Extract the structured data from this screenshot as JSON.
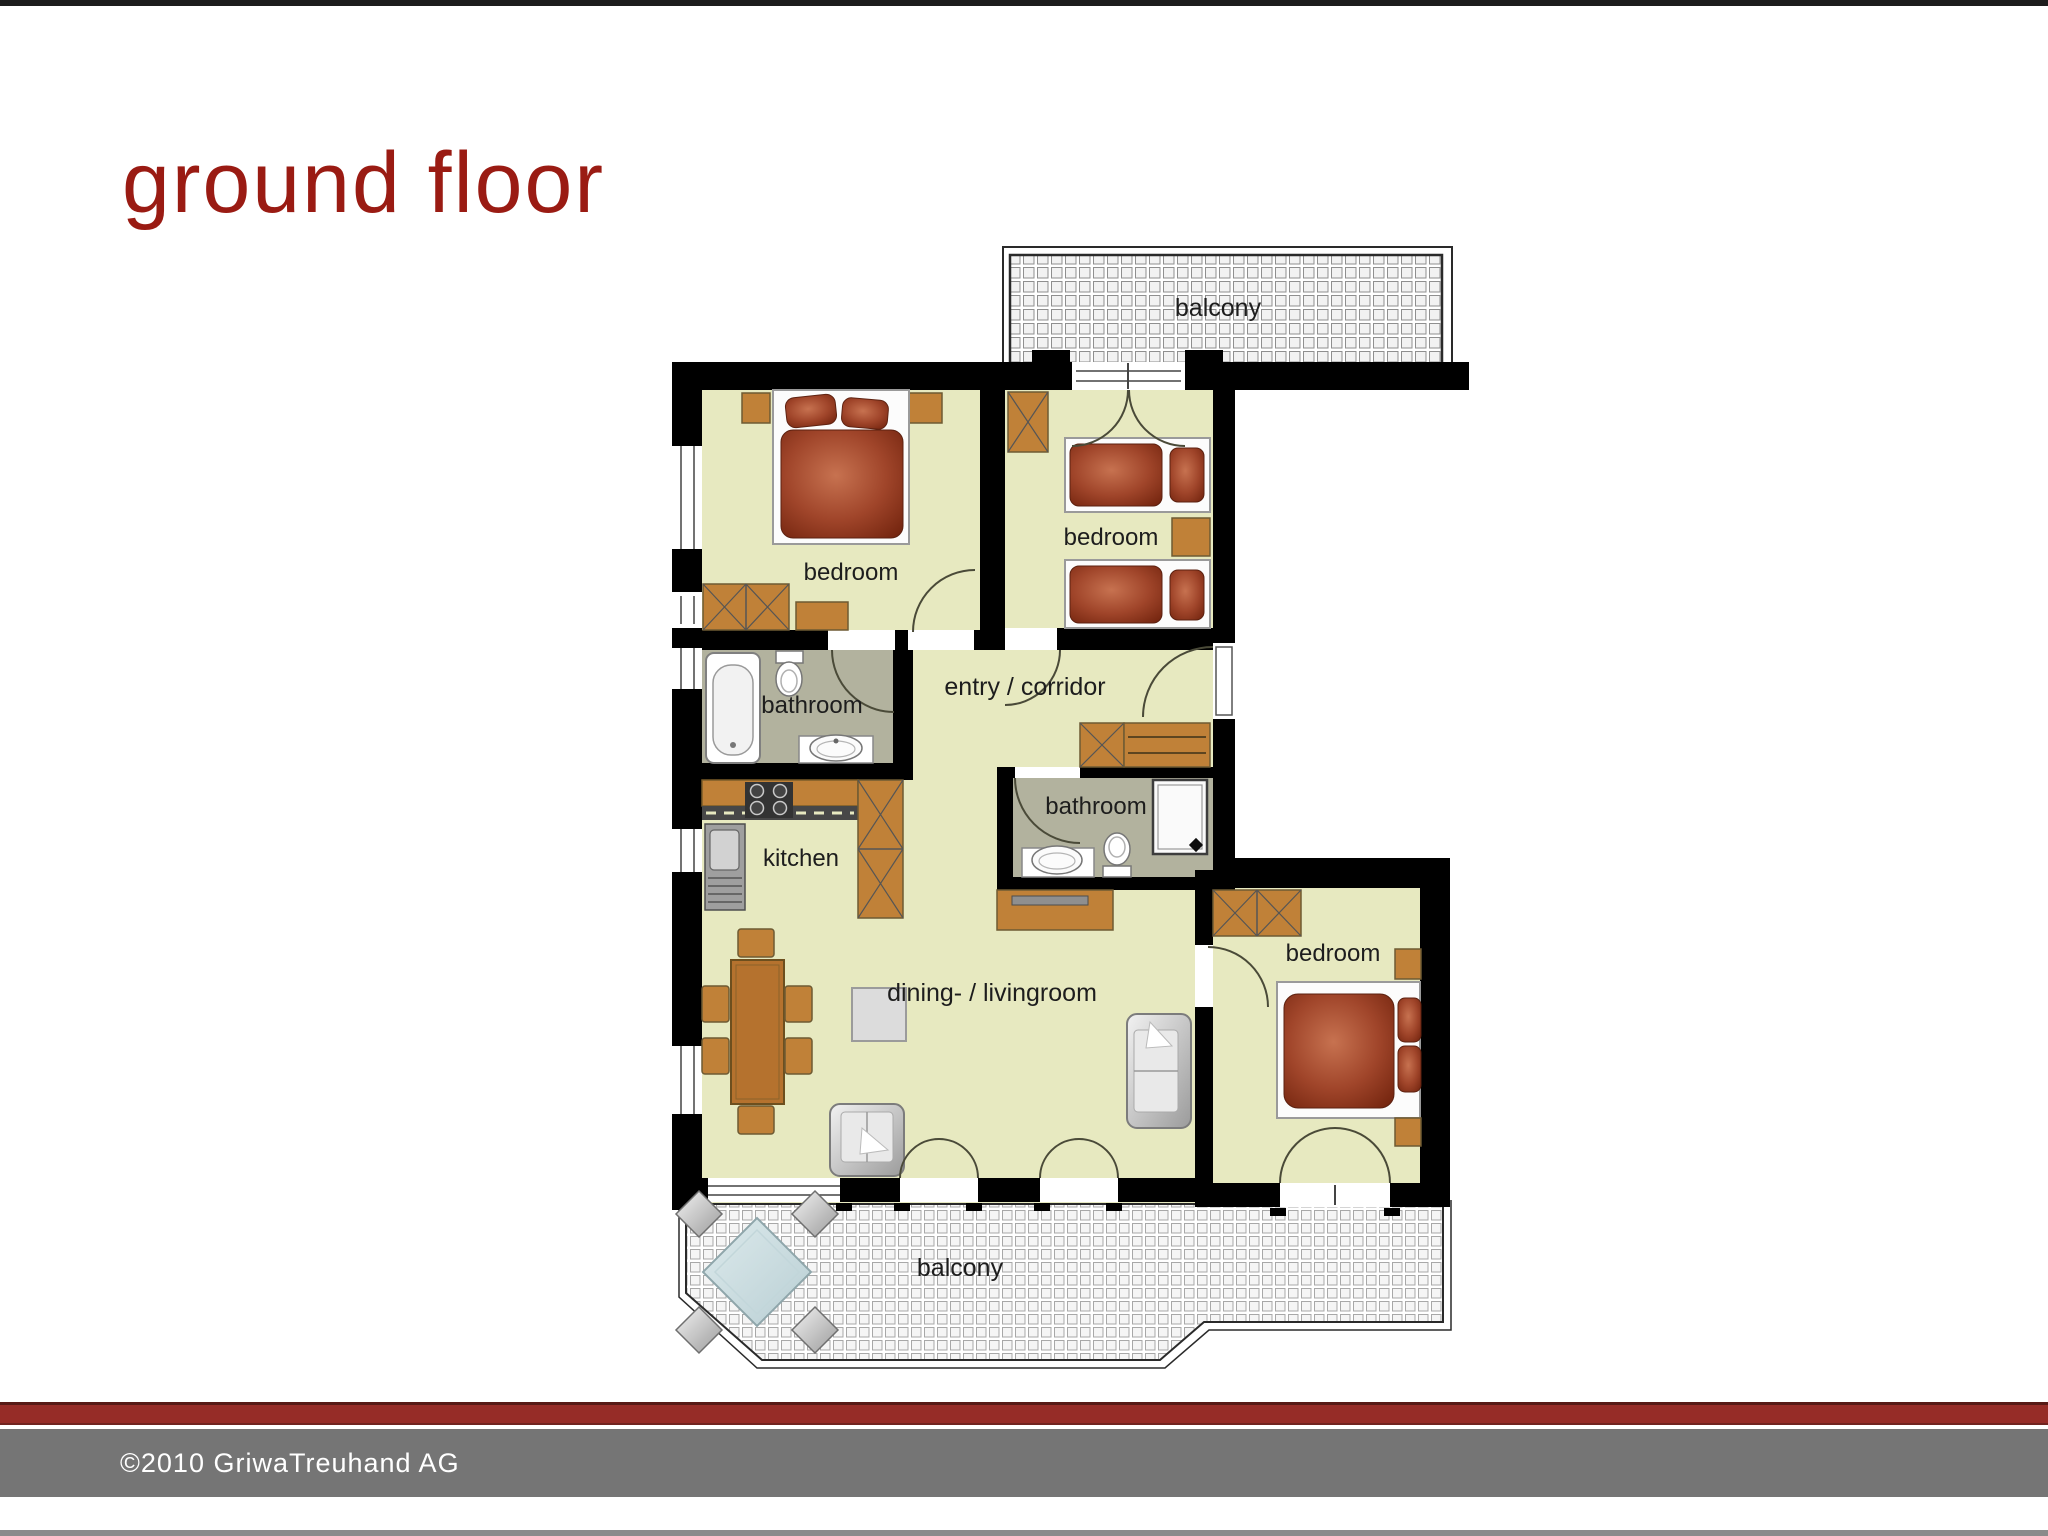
{
  "title": "ground floor",
  "footer": {
    "copyright": "©2010 GriwaTreuhand AG"
  },
  "colors": {
    "accent_red": "#9a1b13",
    "divider_maroon": "#962c27",
    "footer_gray": "#757575",
    "top_bar_black": "#1d1d1d",
    "wall_black": "#000000",
    "room_floor": "#e7e9c0",
    "bathroom_floor": "#b2b29e",
    "furniture_brown": "#c08138",
    "bed_red": "#8a3a22",
    "upholstery_gray": "#c9c9c9"
  },
  "plan": {
    "labels": {
      "balcony_top": "balcony",
      "bedroom_top_left": "bedroom",
      "bedroom_top_right": "bedroom",
      "entry_corridor": "entry / corridor",
      "bathroom_left": "bathroom",
      "bathroom_middle": "bathroom",
      "kitchen": "kitchen",
      "dining_livingroom": "dining- / livingroom",
      "bedroom_right": "bedroom",
      "balcony_bottom": "balcony"
    }
  }
}
